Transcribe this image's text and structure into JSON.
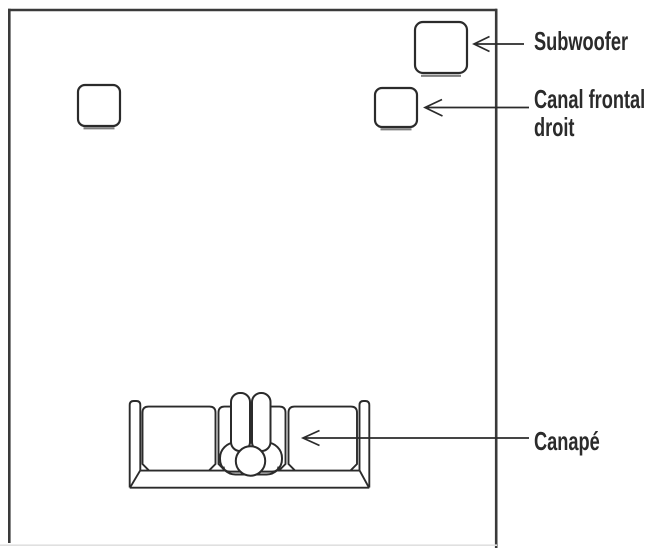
{
  "labels": {
    "subwoofer": "Subwoofer",
    "front_right": [
      "Canal frontal",
      "droit"
    ],
    "sofa": "Canapé"
  },
  "colors": {
    "line": "#2b2b2b",
    "wall": "#3a3a3a",
    "wall_bottom_faint": "#e0e0e0",
    "shadow": "#7d7d7d",
    "text": "#2b2b2b",
    "background": "#ffffff"
  }
}
